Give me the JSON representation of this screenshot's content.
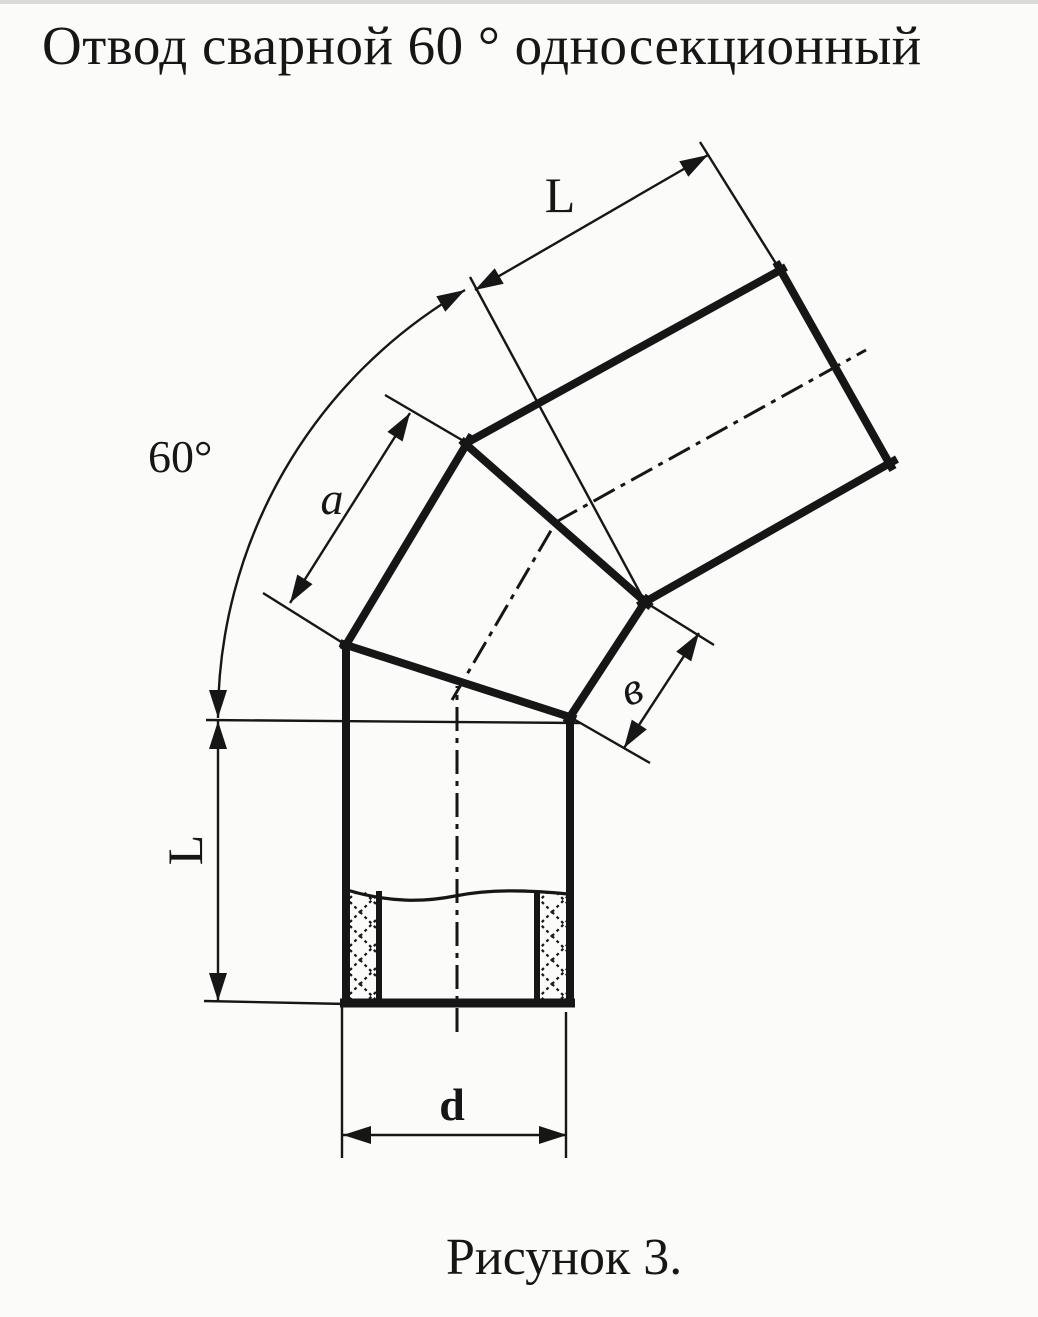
{
  "title": "Отвод сварной 60 ° односекционный",
  "caption": "Рисунок 3.",
  "labels": {
    "top_length": "L",
    "angle": "60°",
    "segment_long_side": "a",
    "segment_short_side": "в",
    "left_length": "L",
    "diameter": "d"
  },
  "colors": {
    "ink": "#161616",
    "paper": "#fbfbfa"
  }
}
